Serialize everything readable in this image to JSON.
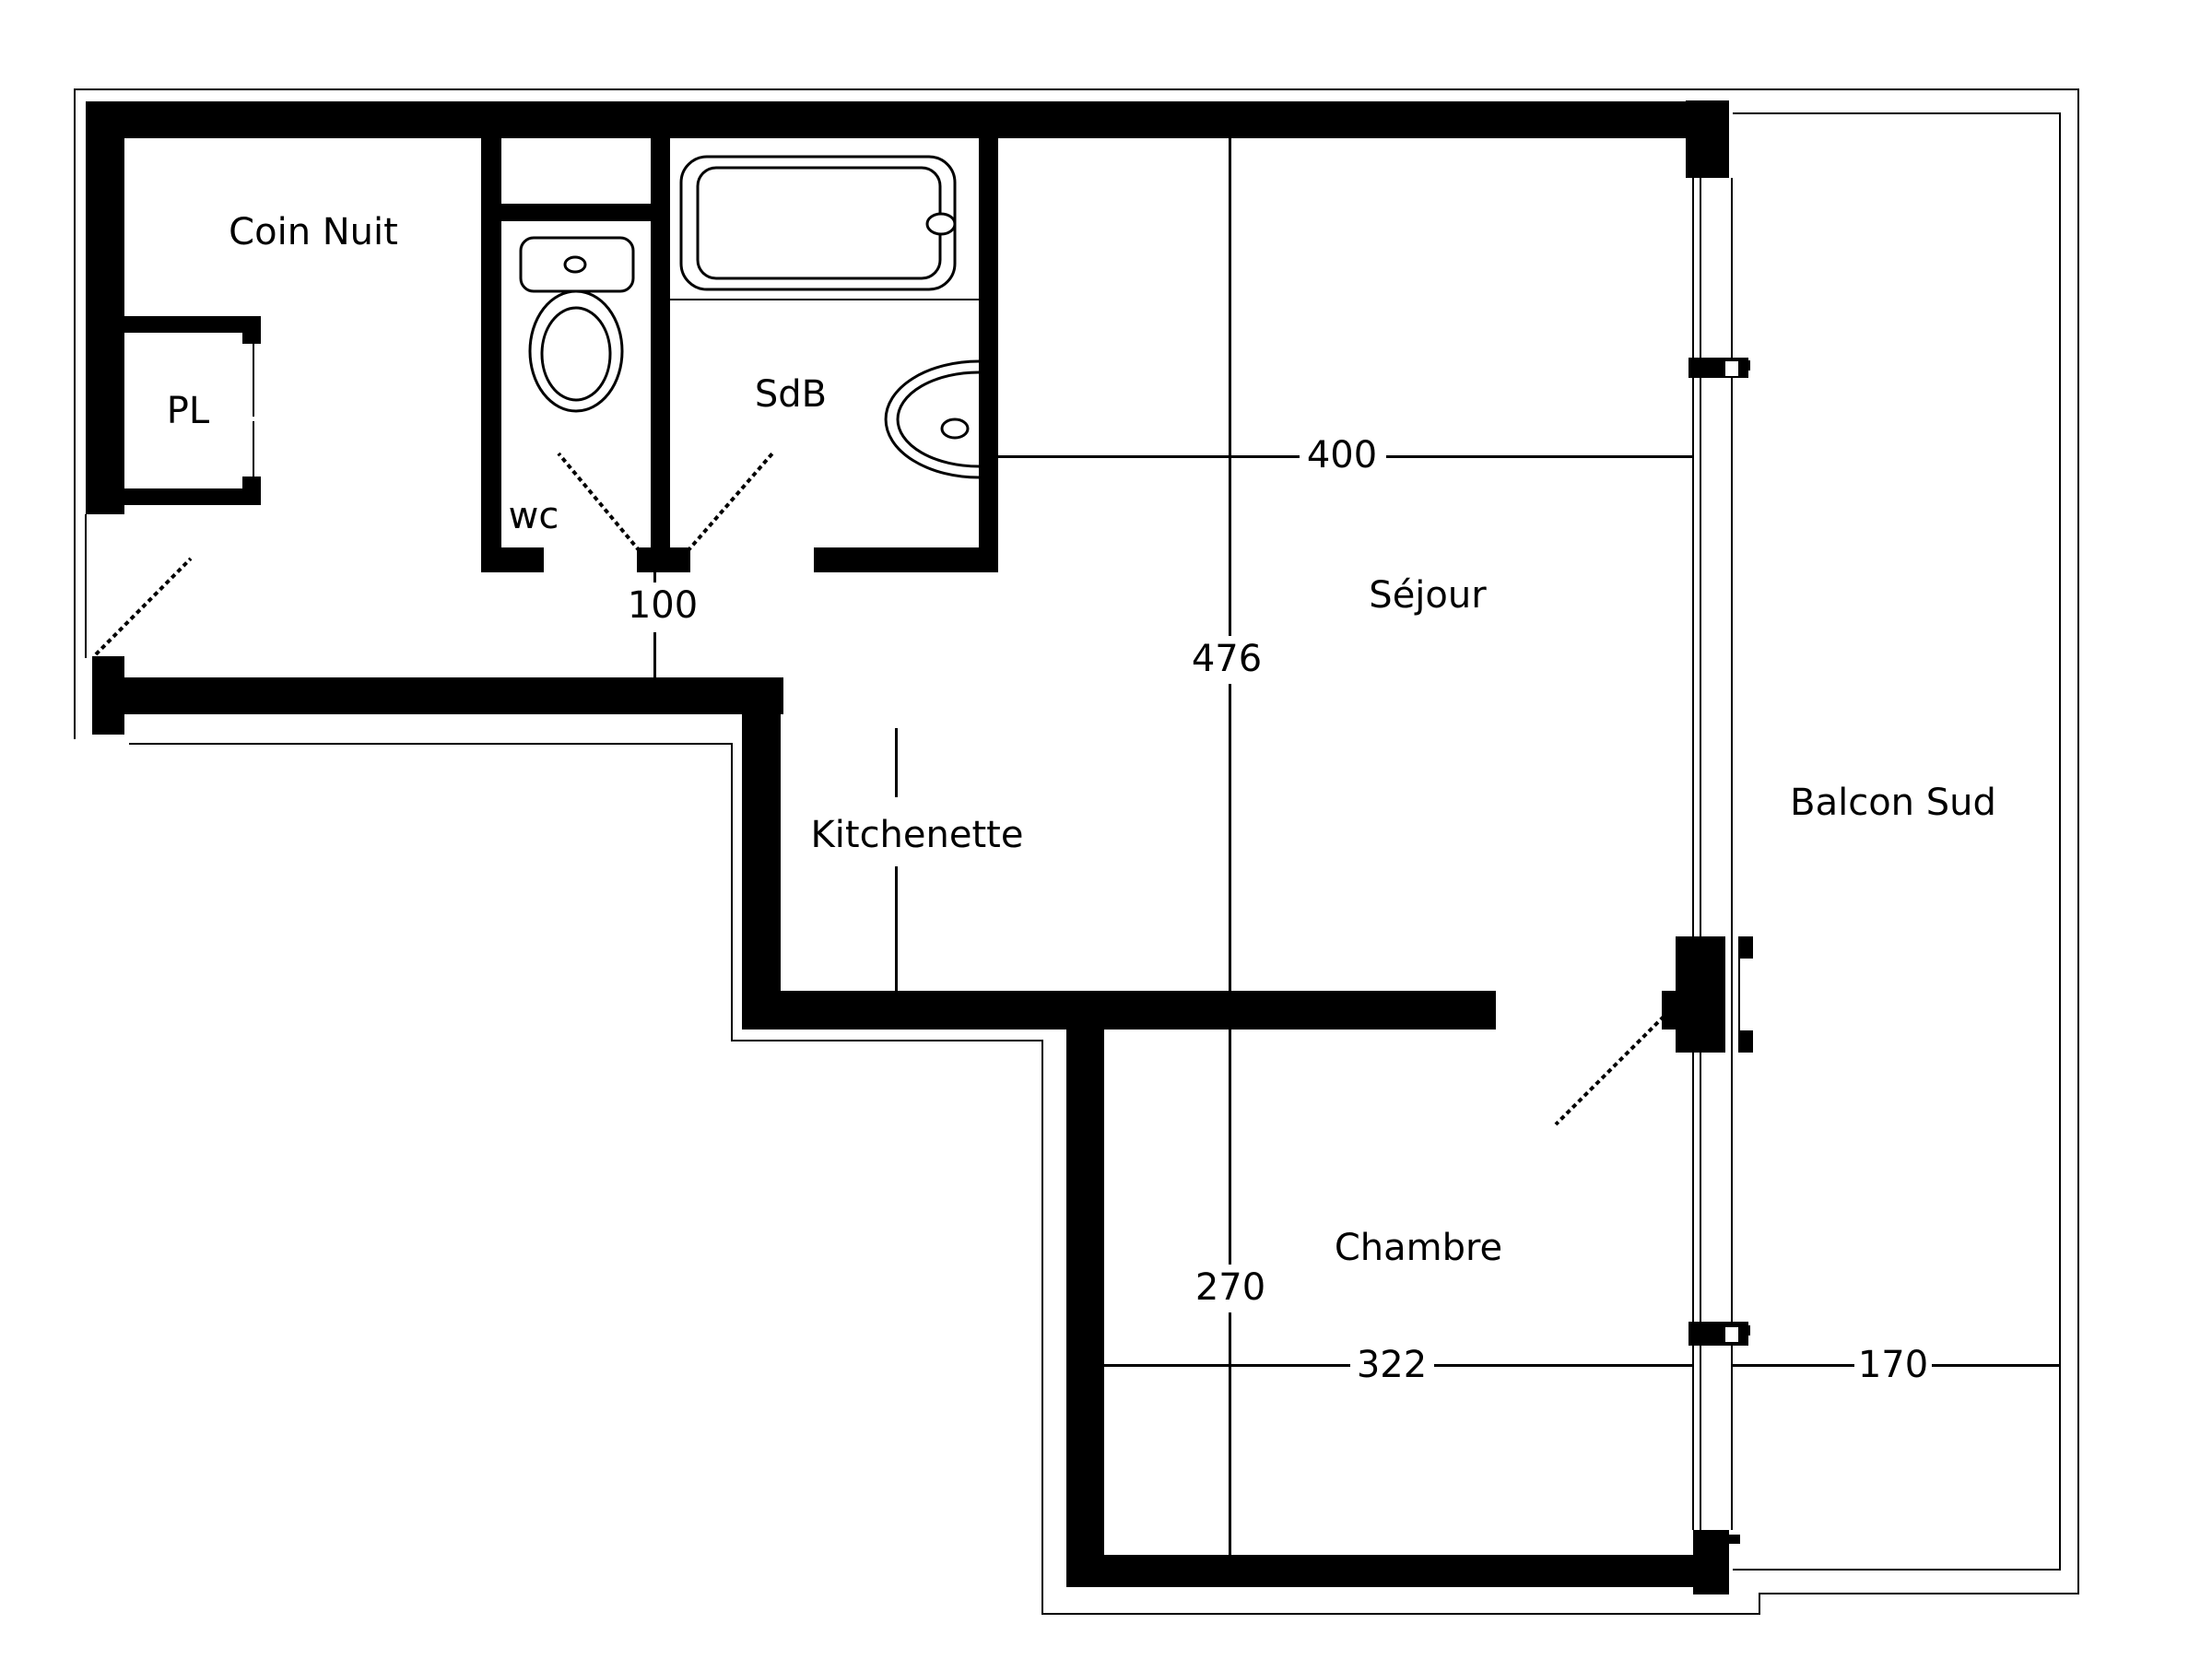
{
  "title": "Floor plan - studio apartment with south balcony",
  "colors": {
    "line": "#000000",
    "background": "#ffffff"
  },
  "rooms": {
    "coin_nuit": {
      "label": "Coin Nuit"
    },
    "pl": {
      "label": "PL"
    },
    "wc": {
      "label": "wc"
    },
    "sdb": {
      "label": "SdB"
    },
    "sejour": {
      "label": "Séjour"
    },
    "kitchenette": {
      "label": "Kitchenette"
    },
    "chambre": {
      "label": "Chambre"
    },
    "balcon": {
      "label": "Balcon Sud"
    }
  },
  "dimensions_cm": {
    "sejour_width": {
      "value": "400"
    },
    "sejour_length": {
      "value": "476"
    },
    "hall_door": {
      "value": "100"
    },
    "chambre_depth": {
      "value": "270"
    },
    "chambre_width": {
      "value": "322"
    },
    "balcon_width": {
      "value": "170"
    }
  },
  "icons": {
    "toilet": "toilet-icon",
    "bathtub": "bathtub-icon",
    "washbasin": "washbasin-icon",
    "door_swing": "door-swing-icon",
    "window_mullion": "window-mullion-icon",
    "balcony_door": "balcony-door-icon"
  }
}
